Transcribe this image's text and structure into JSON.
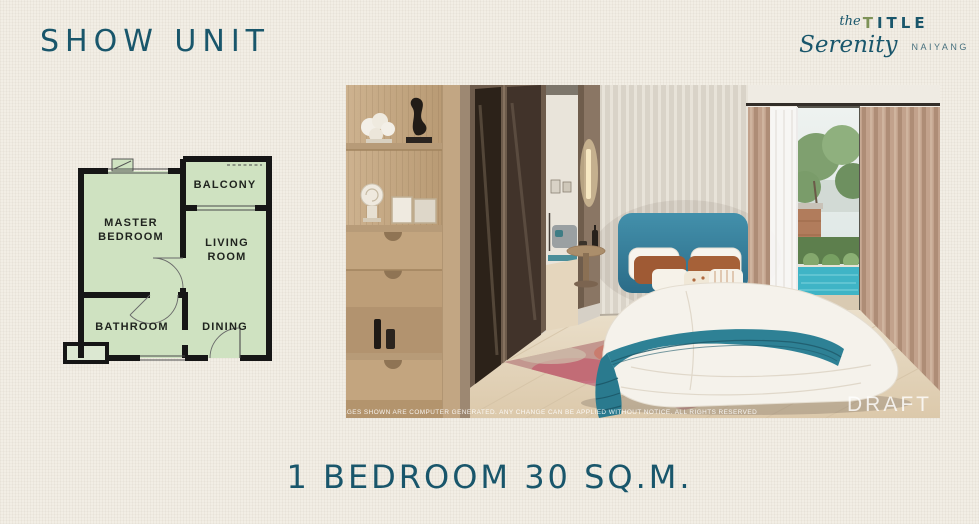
{
  "page": {
    "title": "SHOW UNIT",
    "caption": "1 BEDROOM 30 SQ.M."
  },
  "brand": {
    "the_word": "the",
    "title_first": "T",
    "title_rest": "ITLE",
    "name": "Serenity",
    "location": "NAIYANG"
  },
  "floor_plan": {
    "labels": {
      "master1": "MASTER",
      "master2": "BEDROOM",
      "balcony": "BALCONY",
      "living1": "LIVING",
      "living2": "ROOM",
      "bathroom": "BATHROOM",
      "dining": "DINING"
    }
  },
  "photo": {
    "disclaimer": "*THE IMAGES SHOWN ARE COMPUTER GENERATED. ANY CHANGE CAN BE APPLIED WITHOUT NOTICE. ALL RIGHTS RESERVED",
    "watermark": "DRAFT"
  },
  "colors": {
    "accent_teal": "#19566b",
    "logo_olive": "#7d9257",
    "plan_green": "#cfe2c1",
    "plan_wall": "#161616",
    "headboard_teal": "#3b87a3",
    "throw_teal": "#2e8195",
    "pool": "#3fb4c6",
    "background": "#f2eee5"
  }
}
